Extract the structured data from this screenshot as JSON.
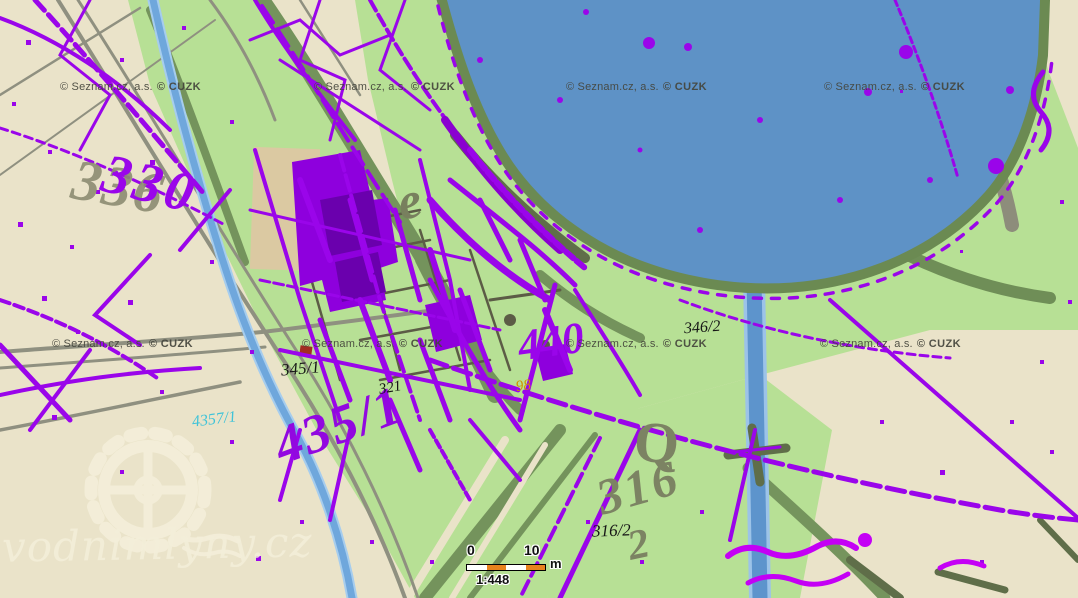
{
  "attribution": {
    "provider": "© Seznam.cz, a.s.",
    "cadastre": "© CUZK"
  },
  "watermark": {
    "site": "vodnimlyny.cz",
    "icon": "waterwheel-gear-icon"
  },
  "scale_bar": {
    "start": "0",
    "end": "10",
    "unit": "m",
    "ratio": "1:448"
  },
  "parcel_labels": [
    {
      "id": "345-1",
      "text": "345/1"
    },
    {
      "id": "321",
      "text": "321"
    },
    {
      "id": "346-2",
      "text": "346/2"
    },
    {
      "id": "316-2",
      "text": "316/2"
    },
    {
      "id": "98",
      "text": "98"
    },
    {
      "id": "4357-1",
      "text": "4357/1"
    }
  ],
  "historic_numbers": [
    {
      "id": "gray-336",
      "text": "336"
    },
    {
      "id": "purple-330",
      "text": "330"
    },
    {
      "id": "purple-435-1",
      "text": "435/1"
    },
    {
      "id": "purple-440",
      "text": "440"
    },
    {
      "id": "olive-316",
      "text": "316"
    },
    {
      "id": "olive-2",
      "text": "2"
    },
    {
      "id": "olive-Q",
      "text": "Q"
    },
    {
      "id": "olive-e",
      "text": "e"
    }
  ],
  "colors": {
    "land_beige": "#eae3c9",
    "vegetation_green": "#b7e095",
    "band_olive": "#74935c",
    "road_gray": "#8f9080",
    "pond_blue": "#5e92c6",
    "stream_blue": "#6fa7dc",
    "cadastre_purple": "#9a05ea",
    "cadastre_magenta": "#c400f5",
    "historic_olive": "#7c8363",
    "label_black": "#161616",
    "label_orange": "#cf9200",
    "label_cyan": "#3fc3d8",
    "scale_orange": "#e8821e",
    "building_fill": "#8e00dd"
  }
}
